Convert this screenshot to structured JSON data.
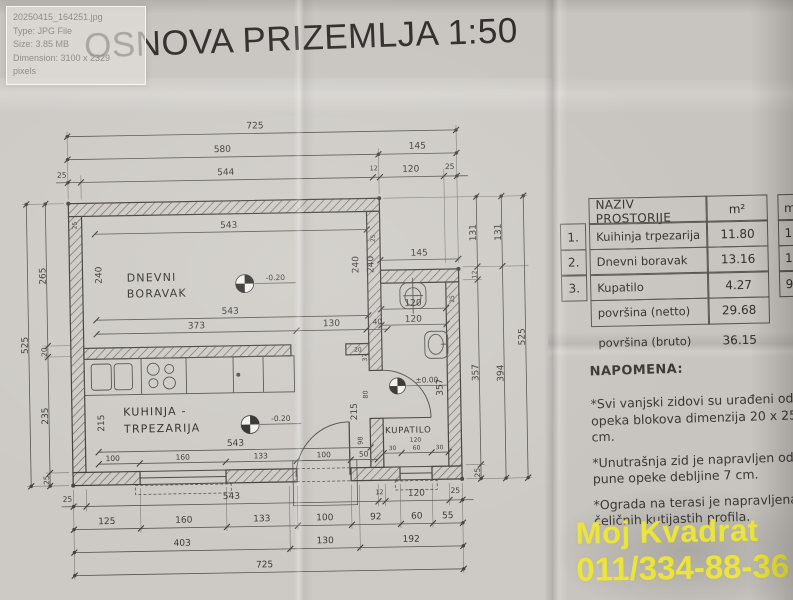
{
  "tooltip": {
    "filename": "20250415_164251.jpg",
    "type": "Type: JPG File",
    "size": "Size: 3.85 MB",
    "dimension": "Dimension: 3100 x 2329",
    "pixels": "pixels"
  },
  "title": "OSNOVA PRIZEMLJA 1:50",
  "plan": {
    "rooms": {
      "living": {
        "line1": "DNEVNI",
        "line2": "BORAVAK",
        "level": "-0.20"
      },
      "kitchen": {
        "line1": "KUHINJA -",
        "line2": "TRPEZARIJA",
        "level": "-0.20"
      },
      "bath": {
        "label": "KUPATILO",
        "level": "±0.00",
        "sub": "120"
      }
    },
    "dims": {
      "top1": [
        "725"
      ],
      "top2": [
        "580",
        "145"
      ],
      "top3": [
        "25",
        "544",
        "12",
        "120",
        "25"
      ],
      "left_outer": [
        "525"
      ],
      "left_inner": [
        "265",
        "20",
        "235",
        "25"
      ],
      "right1": [
        "131",
        "12",
        "357",
        "25"
      ],
      "right2": [
        "131",
        "394"
      ],
      "right3": [
        "525"
      ],
      "annex_top": [
        "145"
      ],
      "bottom1": [
        "25",
        "543",
        "12",
        "120",
        "25"
      ],
      "bottom2": [
        "125",
        "160",
        "133",
        "100",
        "92",
        "60",
        "55"
      ],
      "bottom3": [
        "403",
        "130",
        "192"
      ],
      "bottom4": [
        "725"
      ],
      "living_top": [
        "543"
      ],
      "living_bot": [
        "543"
      ],
      "living_segs": [
        "373",
        "130",
        "40"
      ],
      "living_sides": [
        "240",
        "240",
        "240"
      ],
      "kitchen_sides": [
        "215",
        "215"
      ],
      "kitchen_bot": [
        "543"
      ],
      "kitchen_segs": [
        "100",
        "160",
        "133",
        "100",
        "50"
      ],
      "bath_w": [
        "120",
        "120"
      ],
      "bath_h": [
        "357"
      ],
      "bath_segs": [
        "30",
        "60",
        "30"
      ],
      "door_dims": [
        "37",
        "80",
        "98"
      ],
      "wall_dims": [
        "25",
        "20",
        "25",
        "25"
      ]
    }
  },
  "table": {
    "header": {
      "name": "NAZIV PROSTORIJE",
      "unit": "m²",
      "extra": "m"
    },
    "rows": [
      {
        "num": "1.",
        "name": "Kuihinja trpezarija",
        "area": "11.80",
        "extra": "15"
      },
      {
        "num": "2.",
        "name": "Dnevni boravak",
        "area": "13.16",
        "extra": "15"
      },
      {
        "num": "3.",
        "name": "Kupatilo",
        "area": "4.27",
        "extra": "9."
      }
    ],
    "netto_label": "površina (netto)",
    "netto_value": "29.68",
    "bruto_label": "površina (bruto)",
    "bruto_value": "36.15"
  },
  "notes": {
    "heading": "NAPOMENA:",
    "items": [
      "*Svi vanjski zidovi su urađeni od opeka blokova dimenzija 20 x 25 cm.",
      "*Unutrašnja zid je napravljen od pune opeke debljine 7 cm.",
      "*Ograda na terasi je napravljena od čeličnih kutijastih profila."
    ]
  },
  "branding": {
    "name": "Moj Kvadrat",
    "phone": "011/334-88-36",
    "color": "#eae43e"
  }
}
